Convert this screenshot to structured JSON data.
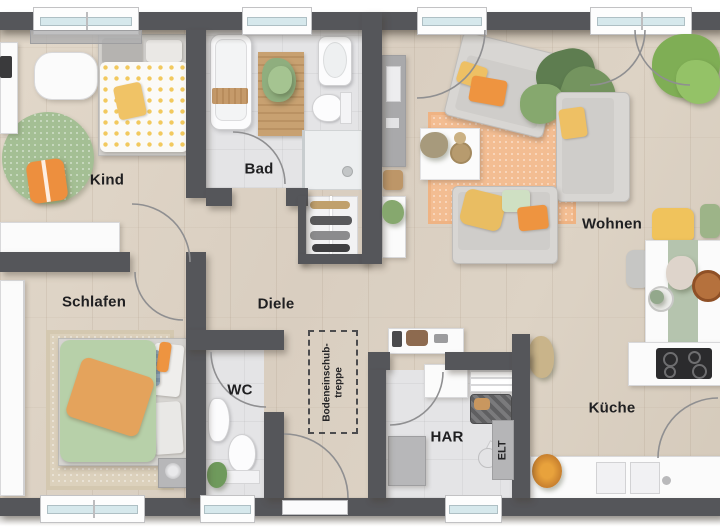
{
  "palette": {
    "wall": "#55565A",
    "wood-floor": "#DCD2C4",
    "tile-floor": "#E3E3E5",
    "glass": "#D6E8EC",
    "accent-orange": "#EE9440",
    "accent-yellow": "#EEC064",
    "accent-green": "#9DBE8D",
    "rug-orange": "#F3BD92",
    "rug-green": "#A4BF94"
  },
  "rooms": [
    {
      "id": "kind",
      "label": "Kind"
    },
    {
      "id": "bad",
      "label": "Bad"
    },
    {
      "id": "wohnen",
      "label": "Wohnen"
    },
    {
      "id": "schlafen",
      "label": "Schlafen"
    },
    {
      "id": "diele",
      "label": "Diele"
    },
    {
      "id": "wc",
      "label": "WC"
    },
    {
      "id": "har",
      "label": "HAR"
    },
    {
      "id": "kueche",
      "label": "Küche"
    }
  ],
  "annotations": {
    "elt": "ELT",
    "attic_stairs_line1": "Bodeneinschub-",
    "attic_stairs_line2": "treppe"
  }
}
